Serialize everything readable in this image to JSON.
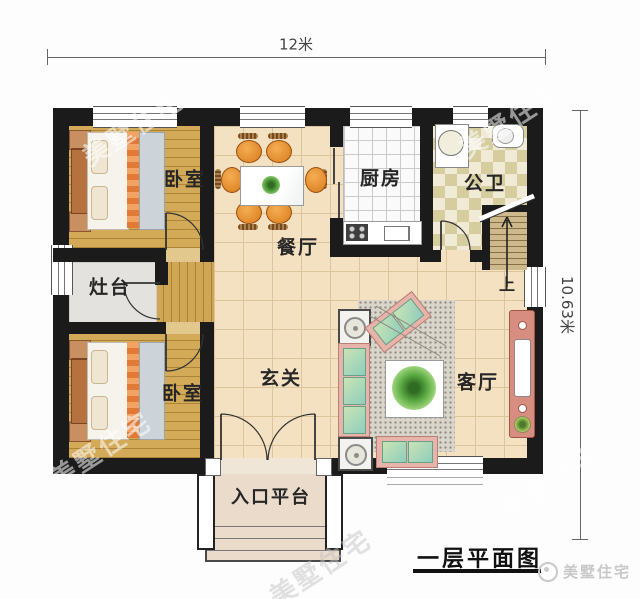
{
  "dimensions": {
    "width": "12米",
    "height": "10.63米"
  },
  "rooms": {
    "bedroom_top": "卧室",
    "bedroom_bottom": "卧室",
    "stove": "灶台",
    "dining": "餐厅",
    "kitchen": "厨房",
    "bathroom": "公卫",
    "foyer": "玄关",
    "living": "客厅",
    "stairs_up": "上",
    "entrance": "入口平台"
  },
  "title": "一层平面图",
  "watermark": {
    "text": "美墅住宅"
  },
  "logo": {
    "text": "美墅住宅"
  },
  "colors": {
    "wall": "#1b1b1b",
    "hall_tile": "#f3e1c1",
    "wood_floor": "#d3aa58",
    "kitchen_floor": "#fafafa",
    "bath_tile": "#d6cd9f",
    "sofa_frame": "#e7b4aa",
    "cushion_green": "#a8d4b8",
    "chair_orange": "#e08a2e",
    "tv_stand": "#d78d80"
  }
}
